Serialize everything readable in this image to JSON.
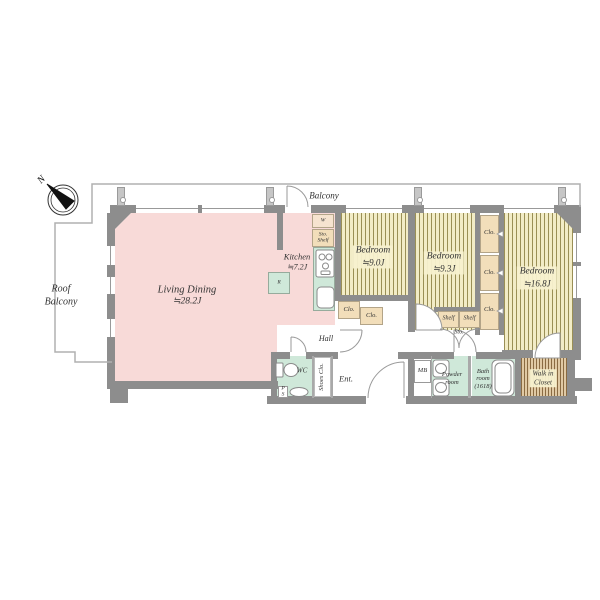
{
  "plan": {
    "compass_n": "N",
    "balcony_label": "Balcony",
    "roof_balcony": {
      "l1": "Roof",
      "l2": "Balcony"
    },
    "living_dining": {
      "name": "Living Dining",
      "area": "≒28.2J"
    },
    "kitchen": {
      "name": "Kitchen",
      "area": "≒7.2J"
    },
    "bedroom_9_0": {
      "name": "Bedroom",
      "area": "≒9.0J"
    },
    "bedroom_9_3": {
      "name": "Bedroom",
      "area": "≒9.3J"
    },
    "bedroom_16_8": {
      "name": "Bedroom",
      "area": "≒16.8J"
    },
    "walk_in_closet": {
      "l1": "Walk in",
      "l2": "Closet"
    },
    "hall_label": "Hall",
    "wc_label": "WC",
    "ent_label": "Ent.",
    "shoes_clo_label": "Shoes Clo.",
    "ps": {
      "l1": "P",
      "l2": "S"
    },
    "mb_label": "MB",
    "powder_room": {
      "l1": "Powder",
      "l2": "room"
    },
    "bath_room": {
      "l1": "Bath",
      "l2": "room",
      "l3": "(1618)"
    },
    "clo_label": "Clo.",
    "shelf_label": "Shelf",
    "sto_label": "Sto.",
    "kitchen_sto_shelf": {
      "l1": "Sto.",
      "l2": "Shelf"
    },
    "washer_label": "W",
    "fridge_label": "R"
  },
  "colors": {
    "wall": "#8d8d8d",
    "room_pink": "#f8dad8",
    "wet_green": "#cfe8d9",
    "closet_tan": "#f2deba",
    "bedroom_floor": "#f2ecc6",
    "bedroom_stripe": "#9a8f55",
    "wic_floor": "#e0c9a4",
    "wic_stripe": "#8a6b42"
  }
}
